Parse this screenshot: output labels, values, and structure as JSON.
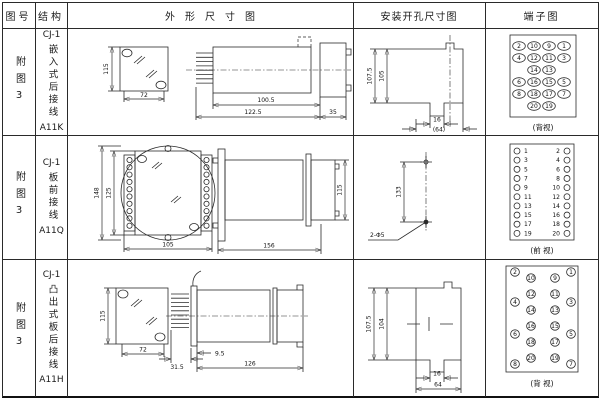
{
  "header": {
    "cols": [
      "图号",
      "结构",
      "外形尺寸图",
      "安装开孔尺寸图",
      "端子图"
    ]
  },
  "rows": [
    {
      "fig": "附图3",
      "struct": {
        "model": "CJ-1",
        "name": "嵌入式后接线",
        "code": "A11K"
      },
      "outline": {
        "front": {
          "height": "115",
          "width": "72"
        },
        "side": {
          "body": "100.5",
          "total": "122.5",
          "flange": "35"
        }
      },
      "mount": {
        "outer": "107.5",
        "inner": "105",
        "slot": "16",
        "span": "(64)"
      },
      "terminal": {
        "view": "(背视)",
        "grid": [
          [
            "2",
            "10",
            "9",
            "1"
          ],
          [
            "4",
            "12",
            "11",
            "3"
          ],
          [
            "",
            "14",
            "13",
            ""
          ],
          [
            "6",
            "16",
            "15",
            "5"
          ],
          [
            "8",
            "18",
            "17",
            "7"
          ],
          [
            "",
            "20",
            "19",
            ""
          ]
        ]
      }
    },
    {
      "fig": "附图3",
      "struct": {
        "model": "CJ-1",
        "name": "板前接线",
        "code": "A11Q"
      },
      "outline": {
        "front": {
          "outer": "148",
          "inner": "125",
          "width": "105"
        },
        "side": {
          "length": "156",
          "height": "115"
        }
      },
      "mount": {
        "spacing": "133",
        "holes": "2-Φ5"
      },
      "terminal": {
        "view": "(前 视)",
        "left": [
          "1",
          "3",
          "5",
          "7",
          "9",
          "11",
          "13",
          "15",
          "17",
          "19"
        ],
        "right": [
          "2",
          "4",
          "6",
          "8",
          "10",
          "12",
          "14",
          "16",
          "18",
          "20"
        ]
      }
    },
    {
      "fig": "附图3",
      "struct": {
        "model": "CJ-1",
        "name": "凸出式板后接线",
        "code": "A11H"
      },
      "outline": {
        "front": {
          "height": "115",
          "width": "72"
        },
        "side": {
          "pins": "31.5",
          "offset": "9.5",
          "length": "126"
        }
      },
      "mount": {
        "outer": "107.5",
        "inner": "104",
        "slot": "16",
        "span": "64"
      },
      "terminal": {
        "view": "(背 视)",
        "outer_left": [
          "2",
          "4",
          "6",
          "8"
        ],
        "inner_left": [
          "10",
          "12",
          "14",
          "16",
          "18",
          "20"
        ],
        "inner_right": [
          "9",
          "11",
          "13",
          "15",
          "17",
          "19"
        ],
        "outer_right": [
          "1",
          "3",
          "5",
          "7"
        ]
      }
    }
  ]
}
